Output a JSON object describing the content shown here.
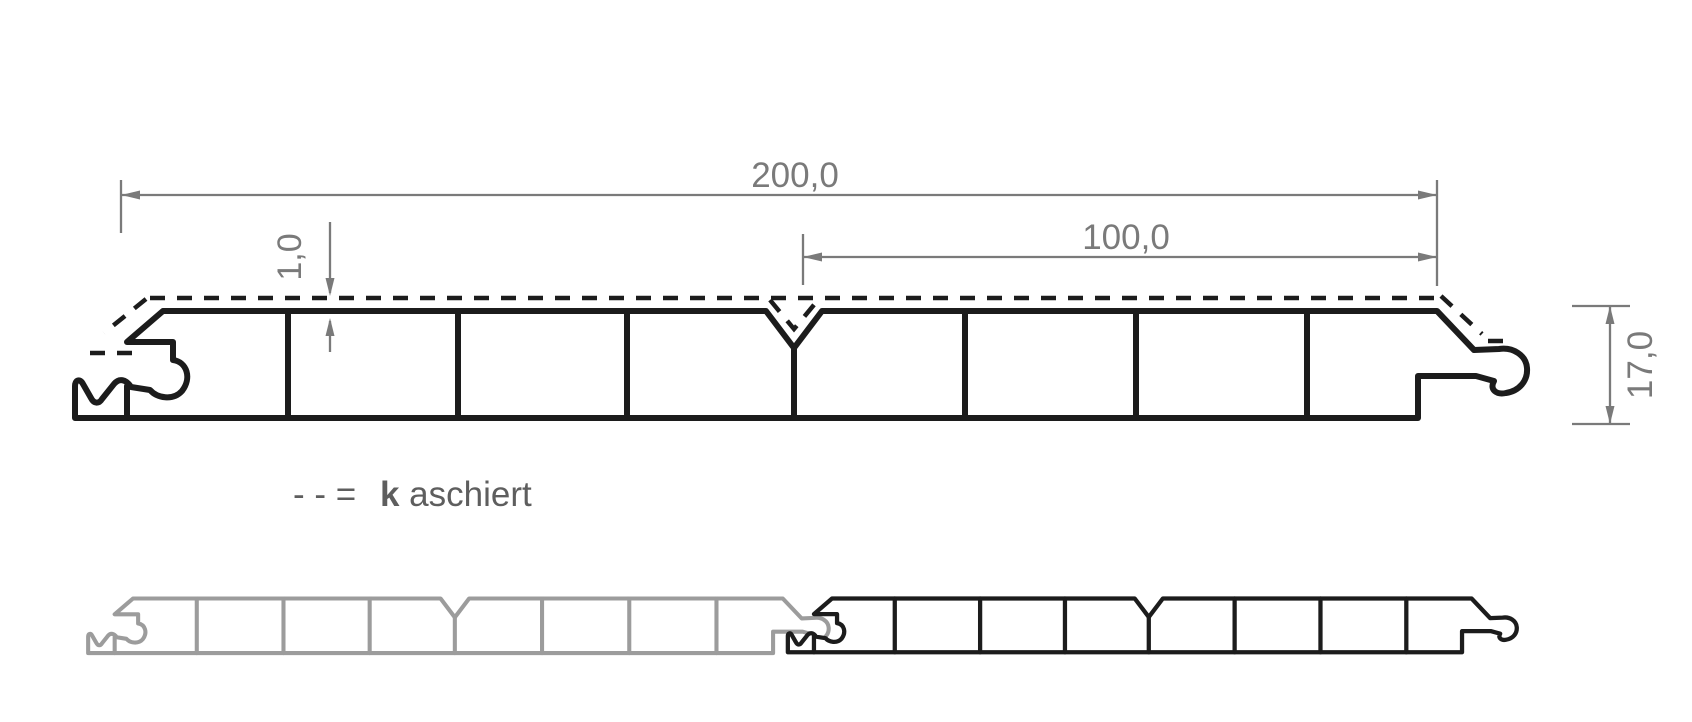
{
  "diagram": {
    "type": "technical-profile-cross-section",
    "dimensions": {
      "total_width": "200,0",
      "half_width": "100,0",
      "lamination_thickness": "1,0",
      "profile_height": "17,0"
    },
    "legend": {
      "symbol": "- - =",
      "term_bold_letter": "k",
      "term_rest": "aschiert"
    },
    "colors": {
      "line": "#1c1c1c",
      "dimension": "#7a7a7a",
      "legend_text": "#5e5e5e",
      "gray_profile": "#9c9c9c",
      "background": "#ffffff"
    }
  }
}
